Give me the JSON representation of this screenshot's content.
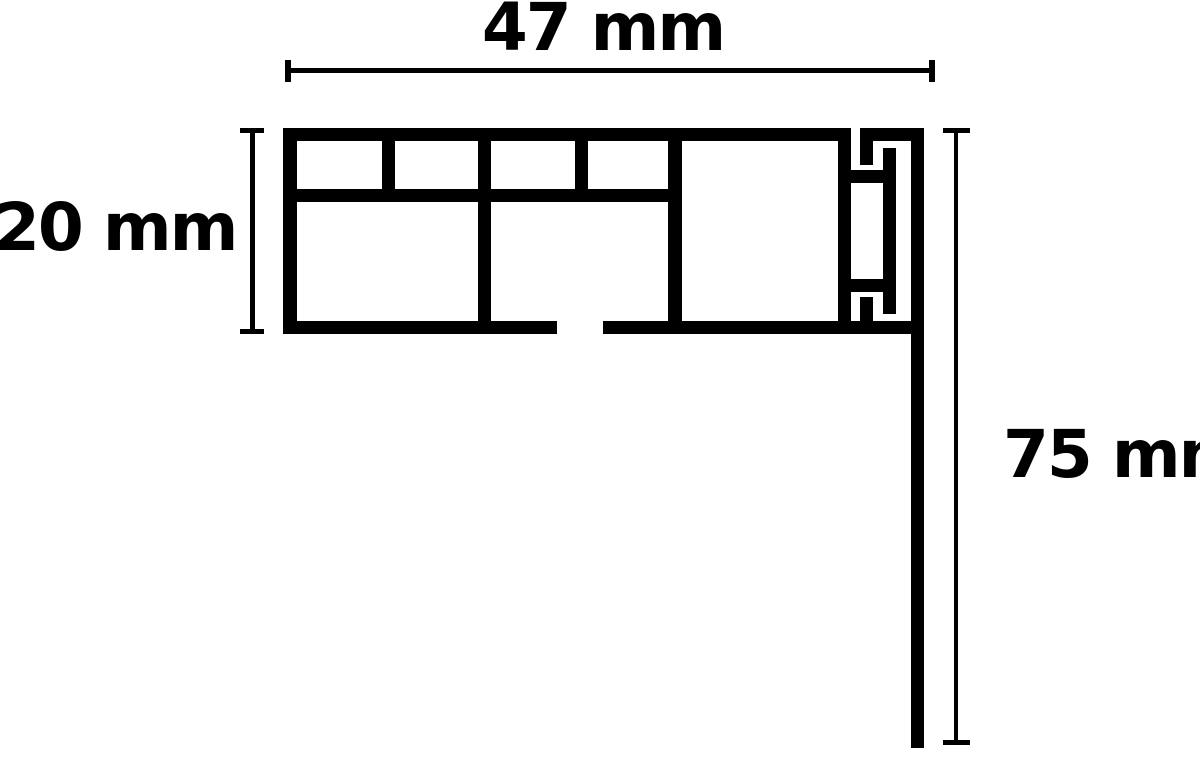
{
  "page": {
    "background_color": "#ffffff"
  },
  "diagram": {
    "type": "technical-cross-section-profile",
    "ink_color": "#000000",
    "dimensions": [
      {
        "id": "width",
        "label": "47 mm",
        "value": 47,
        "unit": "mm",
        "orientation": "horizontal"
      },
      {
        "id": "height",
        "label": "20 mm",
        "value": 20,
        "unit": "mm",
        "orientation": "vertical"
      },
      {
        "id": "drop",
        "label": "75 mm",
        "value": 75,
        "unit": "mm",
        "orientation": "vertical"
      }
    ],
    "profile_segments": [
      [
        283,
        128,
        568,
        13
      ],
      [
        283,
        128,
        14,
        206
      ],
      [
        283,
        321,
        274,
        13
      ],
      [
        603,
        321,
        321,
        13
      ],
      [
        283,
        189,
        399,
        13
      ],
      [
        382,
        128,
        13,
        74
      ],
      [
        478,
        128,
        13,
        206
      ],
      [
        575,
        128,
        13,
        74
      ],
      [
        668,
        128,
        14,
        206
      ],
      [
        838,
        128,
        13,
        206
      ],
      [
        860,
        128,
        64,
        13
      ],
      [
        860,
        141,
        13,
        24
      ],
      [
        838,
        170,
        58,
        13
      ],
      [
        883,
        148,
        13,
        166
      ],
      [
        838,
        279,
        58,
        13
      ],
      [
        860,
        297,
        13,
        24
      ],
      [
        911,
        128,
        13,
        620
      ]
    ],
    "dimension_line_segments": [
      [
        285,
        60,
        6,
        22
      ],
      [
        929,
        60,
        6,
        22
      ],
      [
        291,
        68,
        638,
        5
      ],
      [
        240,
        128,
        24,
        5
      ],
      [
        240,
        329,
        24,
        5
      ],
      [
        250,
        128,
        5,
        206
      ],
      [
        943,
        128,
        27,
        5
      ],
      [
        943,
        740,
        27,
        5
      ],
      [
        954,
        128,
        4,
        617
      ]
    ]
  }
}
